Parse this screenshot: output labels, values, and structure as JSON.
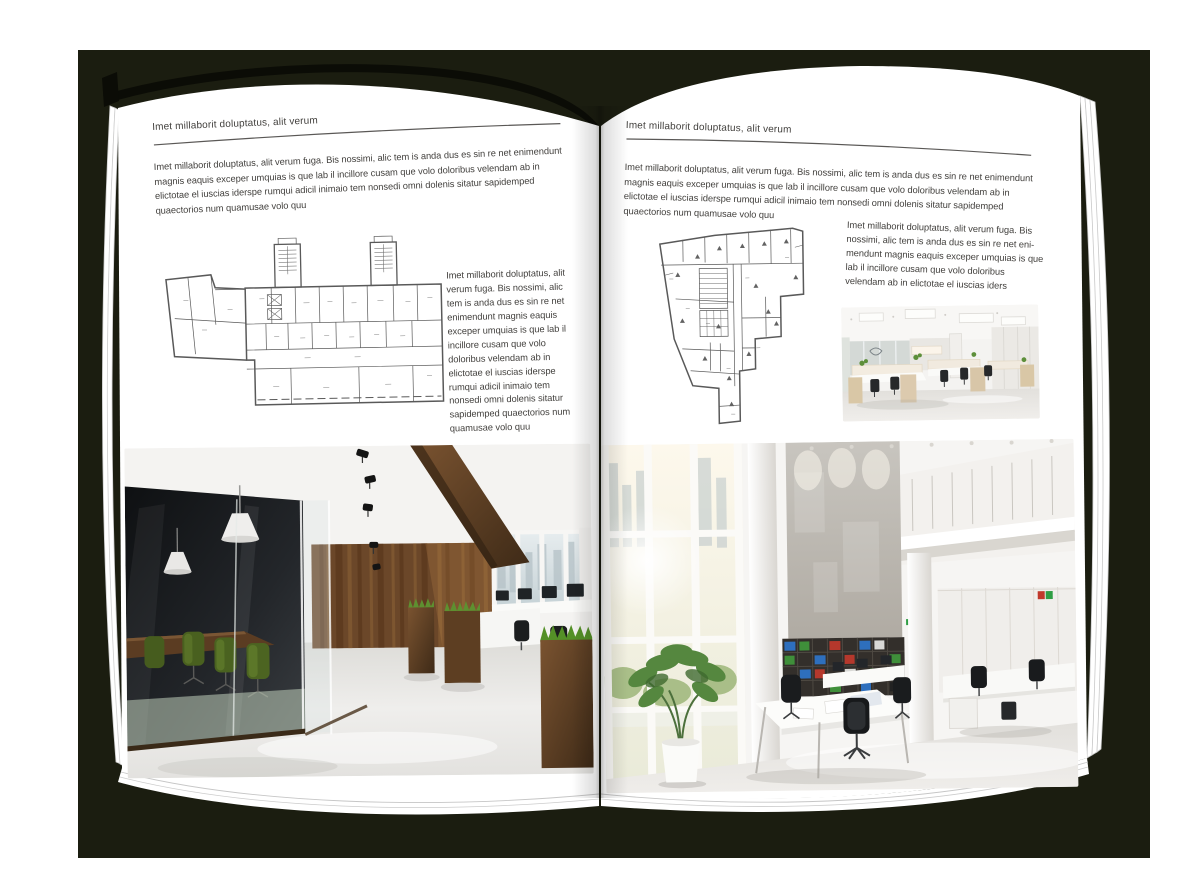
{
  "colors": {
    "backdrop": "#1b1d10",
    "cover": "#0b0c06",
    "page": "#ffffff",
    "text": "#413f3c",
    "rule": "#5a5856"
  },
  "book": {
    "left_page": {
      "header": "Imet millaborit doluptatus, alit verum",
      "intro": "Imet millaborit doluptatus, alit verum fuga. Bis nossimi, alic tem is anda dus es sin re net enimendunt magnis eaquis exceper umquias is que lab il incillore cusam que volo doloribus velendam ab in elictotae el iuscias iderspe rumqui adicil inimaio tem nonsedi omni dolenis sitatur sapidemped quaectorios num quamusae volo quu",
      "side_text": "Imet millaborit doluptatus, alit verum fuga. Bis nossimi, alic tem is anda dus es sin re net enimendunt magnis eaquis exceper umquias is que lab il incillore cusam que volo doloribus velendam ab in elictotae el iuscias iderspe rumqui adicil inimaio tem nonsedi omni dolenis sitatur sapidemped quaectorios num quamusae volo quu"
    },
    "right_page": {
      "header": "Imet millaborit doluptatus, alit verum",
      "intro": "Imet millaborit doluptatus, alit verum fuga. Bis nossimi, alic tem is anda dus es sin re net enimendunt magnis eaquis exceper umquias is que lab il incillore cusam que volo doloribus velendam ab in elictotae el iuscias iderspe rumqui adicil inimaio tem nonsedi omni dolenis sitatur sapidemped quaectorios num quamusae volo quu",
      "side_text": "Imet millaborit doluptatus, alit verum fuga. Bis nossimi, alic tem is anda dus es sin re net eni-mendunt magnis eaquis exceper umquias is que lab il incillore cusam que volo doloribus velendam ab in elictotae el iuscias iders"
    }
  }
}
